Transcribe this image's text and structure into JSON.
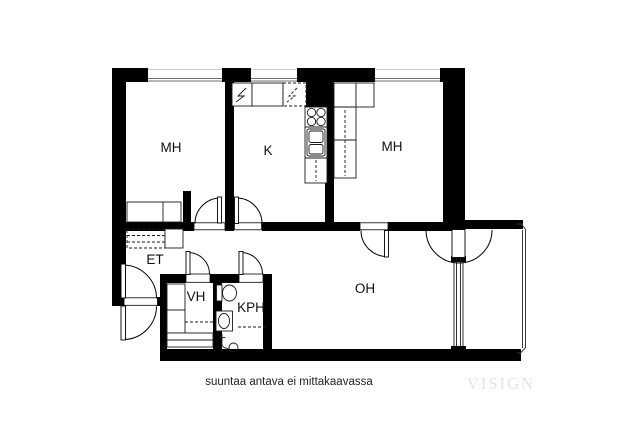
{
  "page": {
    "background": "#ffffff"
  },
  "floorplan": {
    "rooms": [
      {
        "name": "bedroom-left",
        "label": "MH"
      },
      {
        "name": "kitchen",
        "label": "K"
      },
      {
        "name": "bedroom-right",
        "label": "MH"
      },
      {
        "name": "entry-hall",
        "label": "ET"
      },
      {
        "name": "walk-in-closet",
        "label": "VH"
      },
      {
        "name": "bathroom",
        "label": "KPH"
      },
      {
        "name": "living-room",
        "label": "OH"
      }
    ],
    "colors": {
      "wall": "#000000",
      "fixture_line": "#1a1a1a",
      "window_line": "#6f6f6f",
      "watermark": "#e4e4e4"
    }
  },
  "footer": {
    "disclaimer": "suuntaa antava ei mittakaavassa",
    "watermark": "VISIGN"
  }
}
